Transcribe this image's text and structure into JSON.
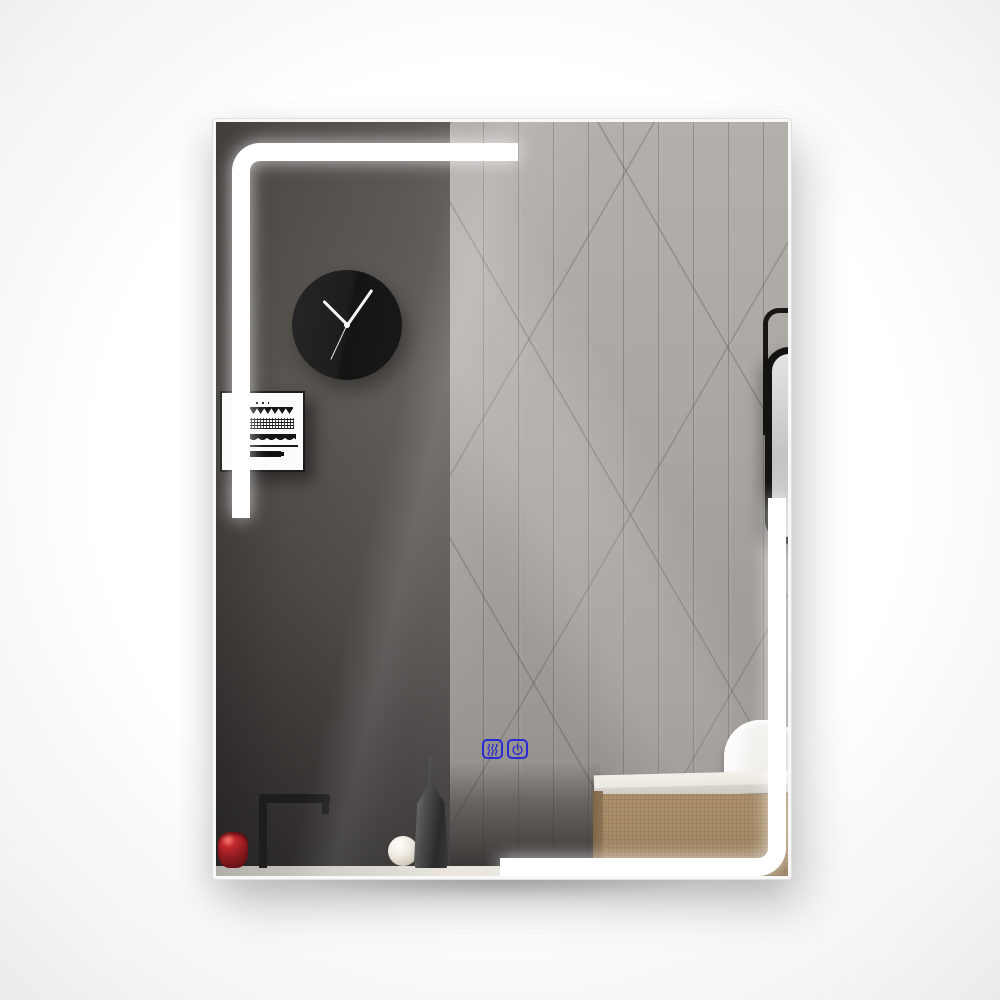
{
  "scene": {
    "description": "rectangular LED bathroom mirror reflecting a wall clock, art print, vanity cabinet with vessel sink, faucet and decor objects"
  },
  "mirror": {
    "led_strip_color": "#ffffff",
    "frame_color": "#f8f8f8"
  },
  "touch_controls": {
    "accent_color": "#2a2ad4",
    "buttons": [
      {
        "icon": "defog-waves-icon"
      },
      {
        "icon": "power-icon"
      }
    ]
  },
  "clock": {
    "hour_angle_deg": -45,
    "minute_angle_deg": 35,
    "second_angle_deg": 205
  },
  "palette": {
    "dark_wall": "#4b4744",
    "tile_wall": "#a8a4a0",
    "vanity_wood": "#a78c68",
    "cup_red": "#8b1a1f",
    "counter": "#e6e2db"
  }
}
